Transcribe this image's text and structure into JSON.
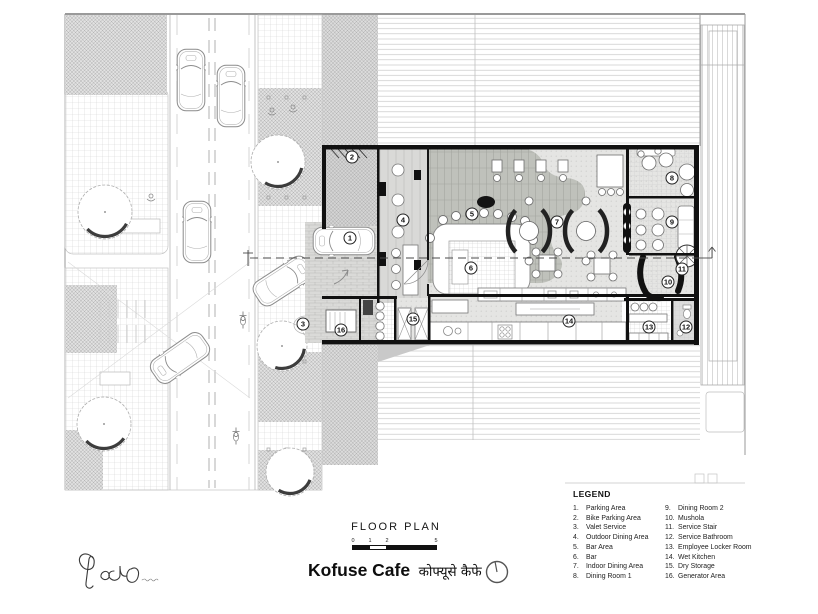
{
  "page": {
    "background": "#ffffff",
    "ink": "#111111",
    "light_line": "#c4c4c4"
  },
  "title_block": {
    "drawing_label": "FLOOR PLAN",
    "project_name": "Kofuse Cafe",
    "project_name_secondary": "कोफ्यूसे कैफे",
    "scale_labels": [
      "0",
      "1",
      "2",
      "5"
    ],
    "north_icon": "north-arrow-icon",
    "logo_icon": "architect-signature-logo"
  },
  "legend": {
    "title": "LEGEND",
    "columns": [
      [
        {
          "n": "1.",
          "label": "Parking Area"
        },
        {
          "n": "2.",
          "label": "Bike Parking Area"
        },
        {
          "n": "3.",
          "label": "Valet Service"
        },
        {
          "n": "4.",
          "label": "Outdoor Dining Area"
        },
        {
          "n": "5.",
          "label": "Bar Area"
        },
        {
          "n": "6.",
          "label": "Bar"
        },
        {
          "n": "7.",
          "label": "Indoor Dining Area"
        },
        {
          "n": "8.",
          "label": "Dining Room 1"
        }
      ],
      [
        {
          "n": "9.",
          "label": "Dining Room 2"
        },
        {
          "n": "10.",
          "label": "Mushola"
        },
        {
          "n": "11.",
          "label": "Service Stair"
        },
        {
          "n": "12.",
          "label": "Service Bathroom"
        },
        {
          "n": "13.",
          "label": "Employee Locker Room"
        },
        {
          "n": "14.",
          "label": "Wet Kitchen"
        },
        {
          "n": "15.",
          "label": "Dry Storage"
        },
        {
          "n": "16.",
          "label": "Generator Area"
        }
      ]
    ]
  },
  "plan": {
    "markers": [
      {
        "n": "1",
        "x": 350,
        "y": 238
      },
      {
        "n": "2",
        "x": 352,
        "y": 157
      },
      {
        "n": "3",
        "x": 303,
        "y": 324
      },
      {
        "n": "4",
        "x": 403,
        "y": 220
      },
      {
        "n": "5",
        "x": 472,
        "y": 214
      },
      {
        "n": "6",
        "x": 471,
        "y": 268
      },
      {
        "n": "7",
        "x": 557,
        "y": 222
      },
      {
        "n": "8",
        "x": 672,
        "y": 178
      },
      {
        "n": "9",
        "x": 672,
        "y": 222
      },
      {
        "n": "10",
        "x": 668,
        "y": 282
      },
      {
        "n": "11",
        "x": 682,
        "y": 269
      },
      {
        "n": "12",
        "x": 686,
        "y": 327
      },
      {
        "n": "13",
        "x": 649,
        "y": 327
      },
      {
        "n": "14",
        "x": 569,
        "y": 321
      },
      {
        "n": "15",
        "x": 413,
        "y": 319
      },
      {
        "n": "16",
        "x": 341,
        "y": 330
      }
    ]
  }
}
